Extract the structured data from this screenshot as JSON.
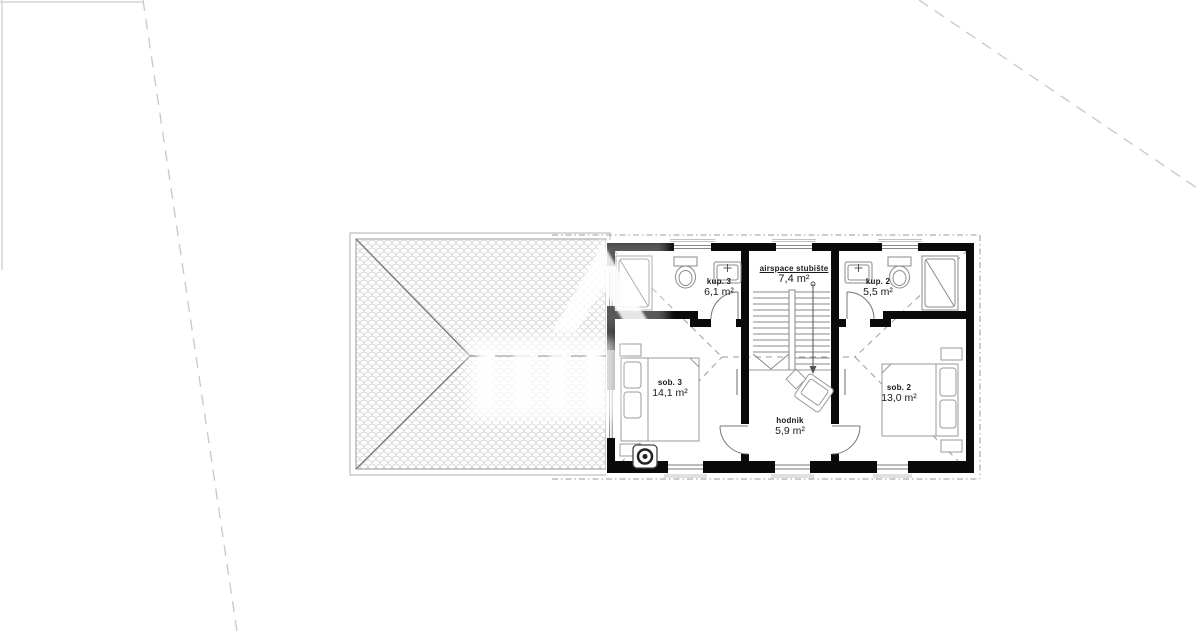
{
  "rooms": {
    "kup3": {
      "name": "kup. 3",
      "area": "6,1 m²"
    },
    "stubiste": {
      "name": "airspace stubište",
      "area": "7,4 m²"
    },
    "kup2": {
      "name": "kup. 2",
      "area": "5,5 m²"
    },
    "sob3": {
      "name": "sob. 3",
      "area": "14,1 m²"
    },
    "sob2": {
      "name": "sob. 2",
      "area": "13,0 m²"
    },
    "hodnik": {
      "name": "hodnik",
      "area": "5,9 m²"
    }
  },
  "colors": {
    "wall": "#0a0a0a",
    "thin_line": "#8a8a8a",
    "roof_hatch": "#cfcfcf",
    "projection_dash": "#9a9a9a",
    "site_boundary_dash": "#c8c8cc",
    "label_text": "#1a1a1a",
    "watermark": "#ffffff"
  }
}
